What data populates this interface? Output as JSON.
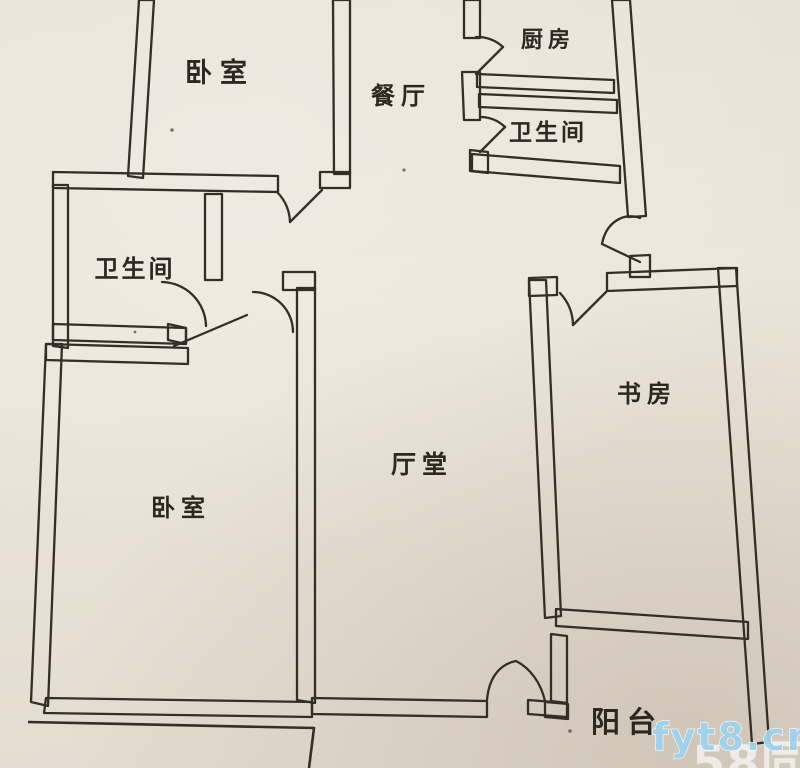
{
  "page": {
    "paper_color": "#e9e2d6",
    "ink_color": "#332e26",
    "watermark_blue": "#9ed2ef"
  },
  "floorplan": {
    "rooms": [
      {
        "id": "bedroom-top-left",
        "label": "卧室"
      },
      {
        "id": "dining-room",
        "label": "餐厅"
      },
      {
        "id": "kitchen",
        "label": "厨房"
      },
      {
        "id": "bathroom-right",
        "label": "卫生间"
      },
      {
        "id": "bathroom-left",
        "label": "卫生间"
      },
      {
        "id": "hall",
        "label": "厅堂"
      },
      {
        "id": "study",
        "label": "书房"
      },
      {
        "id": "bedroom-bottom",
        "label": "卧室"
      },
      {
        "id": "balcony",
        "label": "阳台"
      }
    ]
  },
  "watermarks": {
    "site": {
      "text": "fyt8.cn"
    },
    "brand": {
      "text": "58同城"
    }
  }
}
